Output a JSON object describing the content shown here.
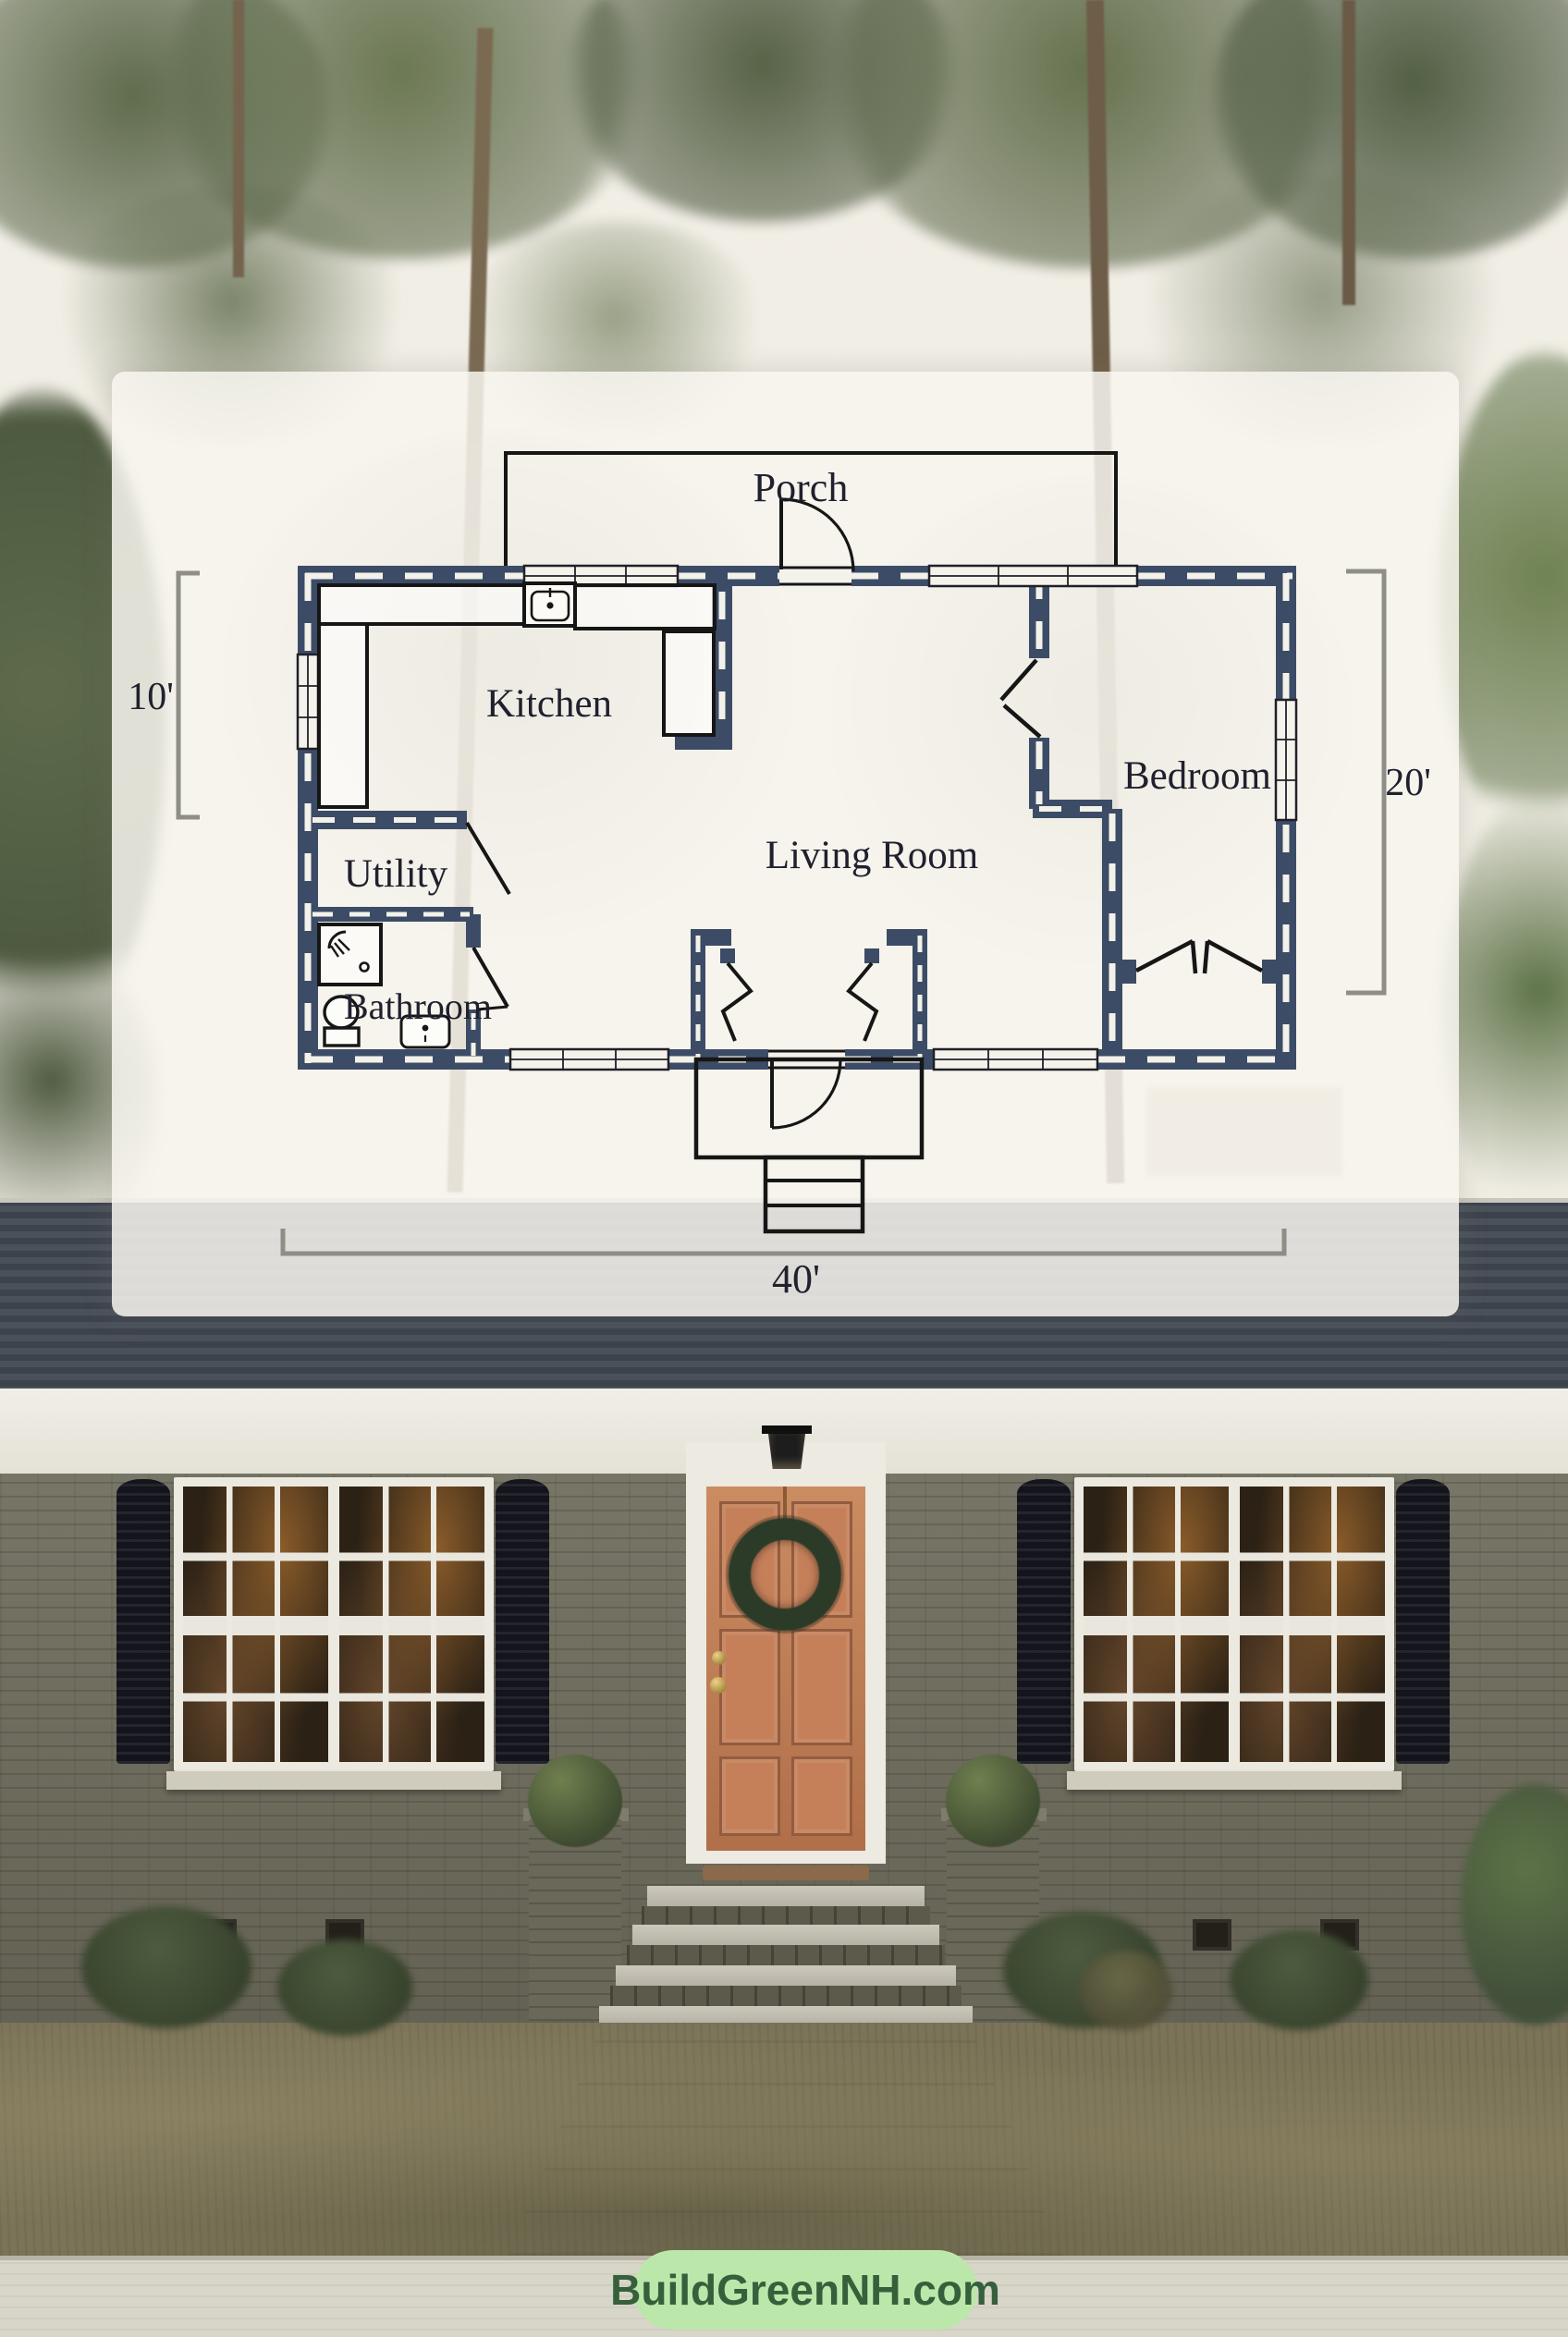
{
  "overlay": {
    "rooms": [
      {
        "name": "Porch"
      },
      {
        "name": "Kitchen"
      },
      {
        "name": "Utility"
      },
      {
        "name": "Bathroom"
      },
      {
        "name": "Living Room"
      },
      {
        "name": "Bedroom"
      }
    ],
    "dimensions": {
      "left": "10'",
      "right": "20'",
      "bottom": "40'"
    }
  },
  "watermark": {
    "text": "BuildGreenNH.com"
  },
  "colors": {
    "wall_navy": "#3d4c66",
    "wall_dash": "#f3f2ea",
    "plan_line": "#161616",
    "dimension_line": "#8f8e86",
    "label_text": "#20202e",
    "pill_bg": "#bce7ab",
    "pill_text": "#35603b",
    "front_door": "#c08257",
    "brick": "#6f6d5d",
    "shutters": "#14141d",
    "roof": "#434a54"
  }
}
